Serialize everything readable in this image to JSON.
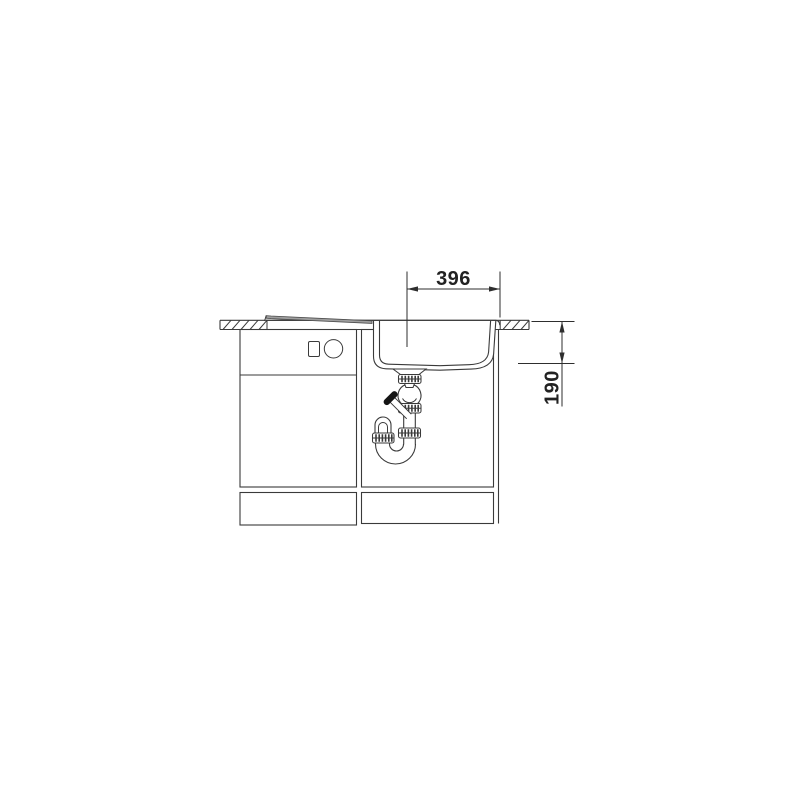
{
  "diagram": {
    "title_hidden": "",
    "background": "#ffffff",
    "line_color": "#3a3a3a",
    "dimension_text_color": "#222222",
    "drainer_fill": "#9e9e9e",
    "inlet_cap_fill": "#151515",
    "dimensions": [
      {
        "label": "396",
        "orientation": "horizontal"
      },
      {
        "label": "190",
        "orientation": "vertical"
      }
    ],
    "components": [
      "worktop-section-left",
      "worktop-section-right",
      "sink-drainer",
      "sink-bowl",
      "drain-flange",
      "slip-nut-upper",
      "ball-joint",
      "slip-nut-middle",
      "dishwasher-inlet",
      "slip-nut-pipe",
      "slip-nut-trap",
      "p-trap-u-bend",
      "base-cabinet-left",
      "base-cabinet-right",
      "cabinet-control-square",
      "cabinet-control-circle"
    ]
  }
}
